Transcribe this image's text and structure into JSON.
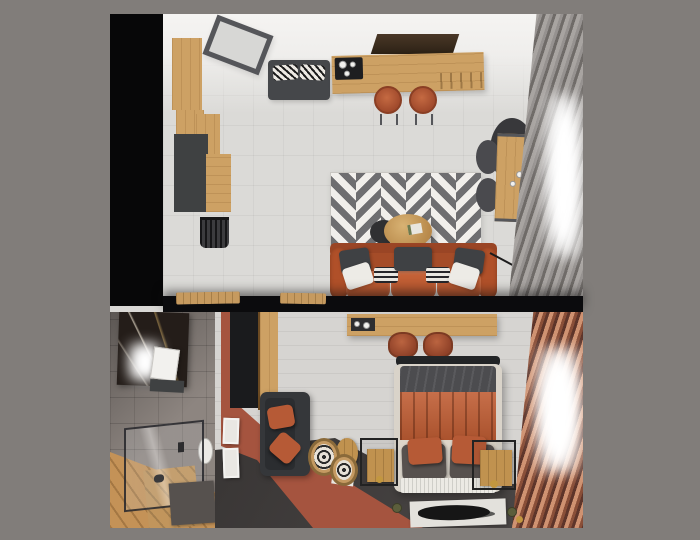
{
  "image": {
    "type": "interior-design-3d-render",
    "description": "Top-down axonometric render of a studio apartment shown as two stacked views: living room with kitchen island (top) and bedroom with en-suite bathroom (bottom), centered on a gray matte background",
    "text_content": "none — image contains no readable text"
  },
  "palette": {
    "matte_background": "#817d7a",
    "black_wall": "#070708",
    "white_wall": "#f3f2f0",
    "floor_tile": "#dbdad7",
    "oak_wood": "#cda164",
    "dark_graphite_furniture": "#3f4142",
    "rust_leather": "#b1522e",
    "terracotta_accent": "#a5543f",
    "gray_curtain": "#8a8683",
    "copper_curtain": "#8a4f38",
    "bedroom_dark_floor": "#454140",
    "gold_accent": "#c2973f",
    "black_marble": "#241d19",
    "chevron_gray": "#6e6e70"
  },
  "rooms": {
    "living_room": {
      "label": "living room and kitchen (top view)",
      "items": [
        "black accent wall",
        "tilted skylight frame",
        "oak wall cabinets",
        "graphite cabinet",
        "wire basket",
        "graphite bench with zigzag pillows",
        "dark tv panel",
        "oak kitchen island with cooktop",
        "two rust bar stools",
        "gray-white chevron rug",
        "rust leather sofa with gray, white and striped pillows",
        "round oak coffee table with dark tray",
        "oak wall desk with dark chair",
        "round dark side table",
        "brass floor lamp",
        "gray pleated curtains",
        "bright window light"
      ]
    },
    "bedroom": {
      "label": "bedroom (bottom view)",
      "items": [
        "oak wall desk with vanity items",
        "two rust chairs",
        "bed with dark crumpled blanket and rust quilted duvet",
        "dark and rust pillows",
        "striped mattress bench",
        "white rug with black brush stroke",
        "oak nightstands with black metal frames",
        "round oak side table with magazine",
        "two rattan poufs",
        "graphite loveseat with rust pillows",
        "white botanical art frames",
        "terracotta partition wall",
        "oak wardrobe",
        "copper pleated curtains",
        "bright window light",
        "small plants and gold sphere decor"
      ]
    },
    "bathroom": {
      "label": "bathroom and hallway (bottom-left)",
      "items": [
        "black marble wall panel",
        "glowing wall lamp",
        "white mirror cabinet",
        "glass shower enclosure",
        "oak bench",
        "toilet",
        "dark gray bath mat",
        "diagonal oak plank floor"
      ]
    }
  }
}
